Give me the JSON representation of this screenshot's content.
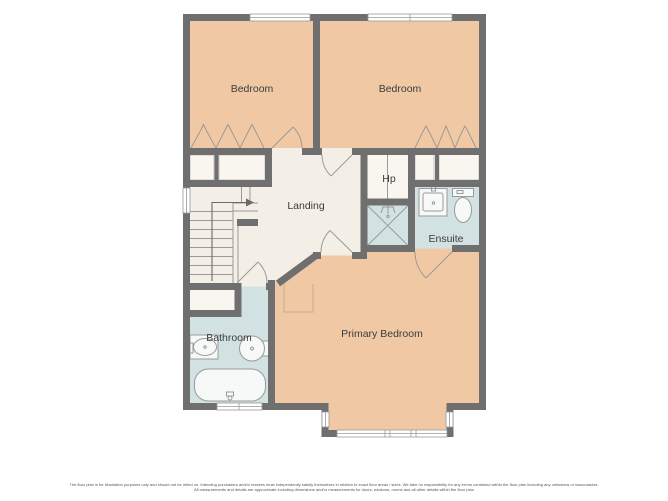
{
  "plan": {
    "rooms": [
      {
        "id": "bedroom-1",
        "label": "Bedroom"
      },
      {
        "id": "bedroom-2",
        "label": "Bedroom"
      },
      {
        "id": "landing",
        "label": "Landing"
      },
      {
        "id": "hot-press",
        "label": "Hp"
      },
      {
        "id": "ensuite",
        "label": "Ensuite"
      },
      {
        "id": "bathroom",
        "label": "Bathroom"
      },
      {
        "id": "primary-bedroom",
        "label": "Primary Bedroom"
      }
    ],
    "fixtures": [
      "stairs-with-up-arrow",
      "shower-tray",
      "bathtub",
      "toilet",
      "wash-basin",
      "wardrobe-arches",
      "bay-window",
      "door-swings"
    ],
    "colors": {
      "wall": "#6f6f6f",
      "bedroom_fill": "#f0c9a4",
      "wet_room_fill": "#d2e2e2",
      "landing_fill": "#f4efe6",
      "closet_fill": "#f9f6f0",
      "line": "#9a9a9a",
      "label_text": "#3c3c3c",
      "disclaimer_text": "#555555",
      "background": "#ffffff"
    }
  },
  "disclaimer": {
    "line1": "The floor plan is for illustration purposes only and should not be relied on. Intending purchasers and/or lessees must independently satisfy themselves in relation to exact floor areas / sizes. We take no responsibility for any errors contained within the floor plan including any omissions or inaccuracies.",
    "line2": "All measurements and details are approximate including dimensions and/or measurements for doors, windows, rooms and all other details within the floor plan"
  }
}
